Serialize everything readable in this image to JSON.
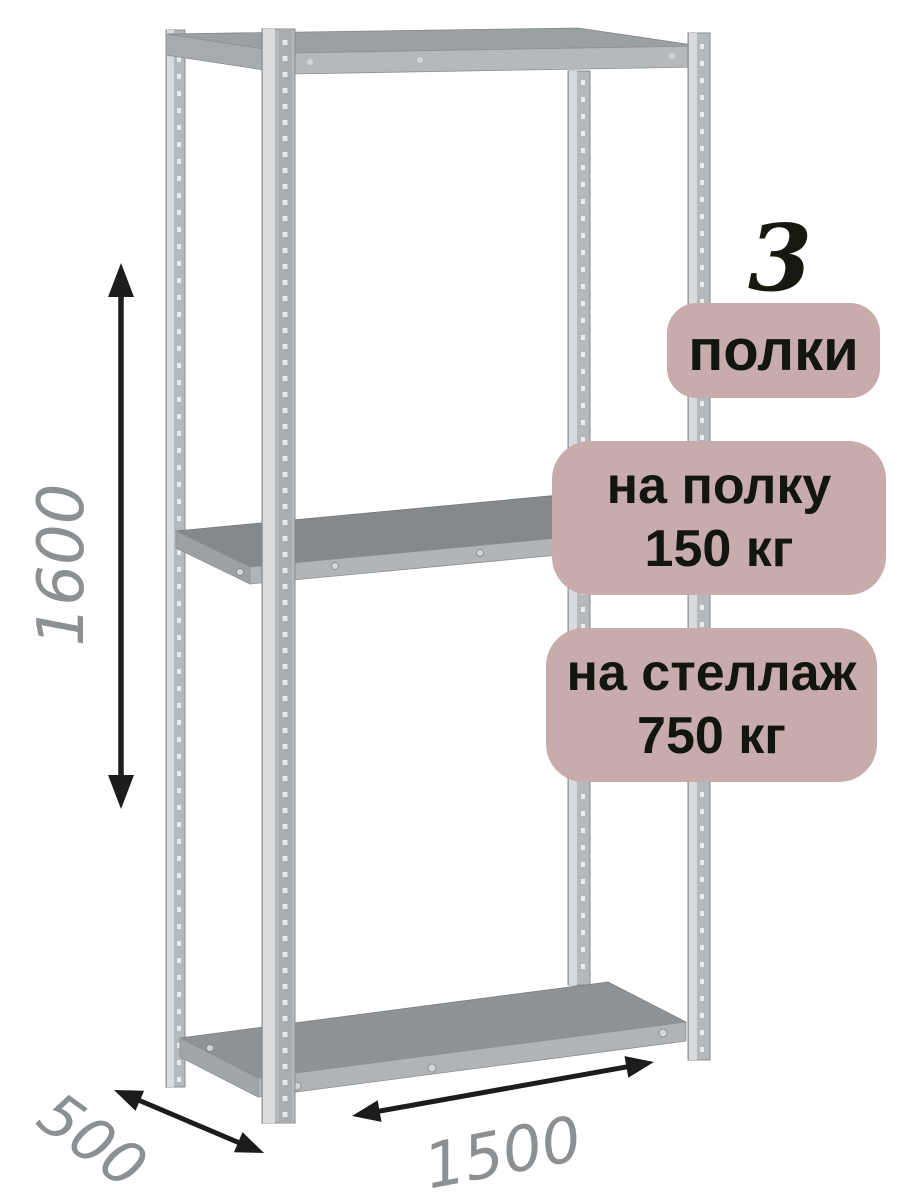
{
  "product_badges": {
    "shelf_count_number": "3",
    "shelf_count_label": "полки",
    "shelf_load": {
      "line1": "на полку",
      "line2": "150 кг"
    },
    "rack_load": {
      "line1": "на стеллаж",
      "line2": "750 кг"
    }
  },
  "dimensions": {
    "height": "1600",
    "depth": "500",
    "width": "1500"
  },
  "colors": {
    "badge_background": "#c8abab",
    "badge_text": "#12160f",
    "count_number_text": "#16190f",
    "dimension_label_text": "#8d9092",
    "dimension_arrow": "#1c1c1c",
    "rack_metal_light": "#d9dbdd",
    "rack_metal_mid": "#b5b9bc",
    "rack_metal_dark": "#85898c"
  },
  "illustration": {
    "shelves_visible": 3,
    "posts_visible": 4
  }
}
